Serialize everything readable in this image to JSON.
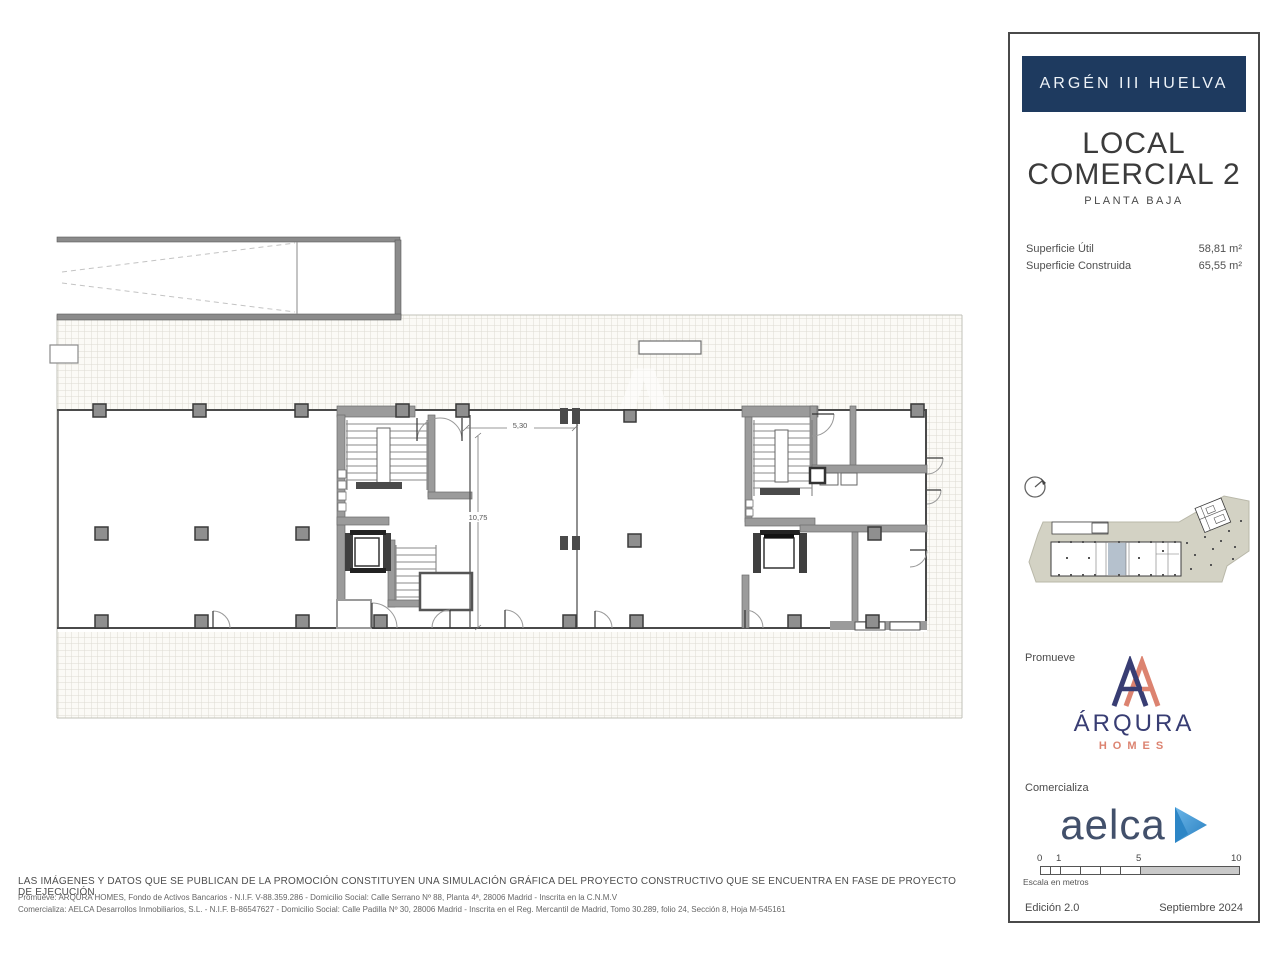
{
  "panel": {
    "project_title": "ARGÉN III HUELVA",
    "unit_title_line1": "LOCAL",
    "unit_title_line2": "COMERCIAL 2",
    "floor_label": "PLANTA BAJA",
    "areas": [
      {
        "label": "Superficie Útil",
        "value": "58,81 m²"
      },
      {
        "label": "Superficie Construida",
        "value": "65,55 m²"
      }
    ],
    "promoter_section_label": "Promueve",
    "promoter_logo_text": "ÁRQURA",
    "promoter_logo_subtext": "HOMES",
    "seller_section_label": "Comercializa",
    "seller_logo_text": "aelca",
    "scale_bar": {
      "tick_labels": [
        "0",
        "1",
        "5",
        "10"
      ],
      "caption": "Escala en metros"
    },
    "edition": "Edición 2.0",
    "date": "Septiembre 2024"
  },
  "plan": {
    "dimension_width_label": "5,30",
    "dimension_depth_label": "10,75",
    "watermark_letter": "A"
  },
  "footer": {
    "disclaimer": "LAS IMÁGENES Y DATOS QUE SE PUBLICAN DE LA PROMOCIÓN CONSTITUYEN UNA SIMULACIÓN GRÁFICA DEL PROYECTO CONSTRUCTIVO QUE SE ENCUENTRA EN FASE DE PROYECTO DE EJECUCIÓN",
    "promoter_line": "Promueve: ARQURA HOMES, Fondo de Activos Bancarios - N.I.F. V-88.359.286 - Domicilio Social: Calle Serrano Nº 88, Planta 4ª, 28006 Madrid - Inscrita en la C.N.M.V",
    "seller_line": "Comercializa: AELCA Desarrollos Inmobiliarios, S.L. - N.I.F. B-86547627 - Domicilio Social: Calle Padilla Nº 30, 28006 Madrid - Inscrita en el Reg. Mercantil de Madrid, Tomo 30.289, folio 24, Sección 8, Hoja M-545161"
  },
  "colors": {
    "header_navy": "#1E3A5F",
    "arqura_navy": "#383D73",
    "arqura_coral": "#DC8370",
    "aelca_text": "#42506B",
    "aelca_triangle": "#4AA3DD",
    "site_plan_beige": "#D3D2C4",
    "highlight_unit": "#B5C1CD",
    "wall_gray": "#9B9B9B"
  }
}
